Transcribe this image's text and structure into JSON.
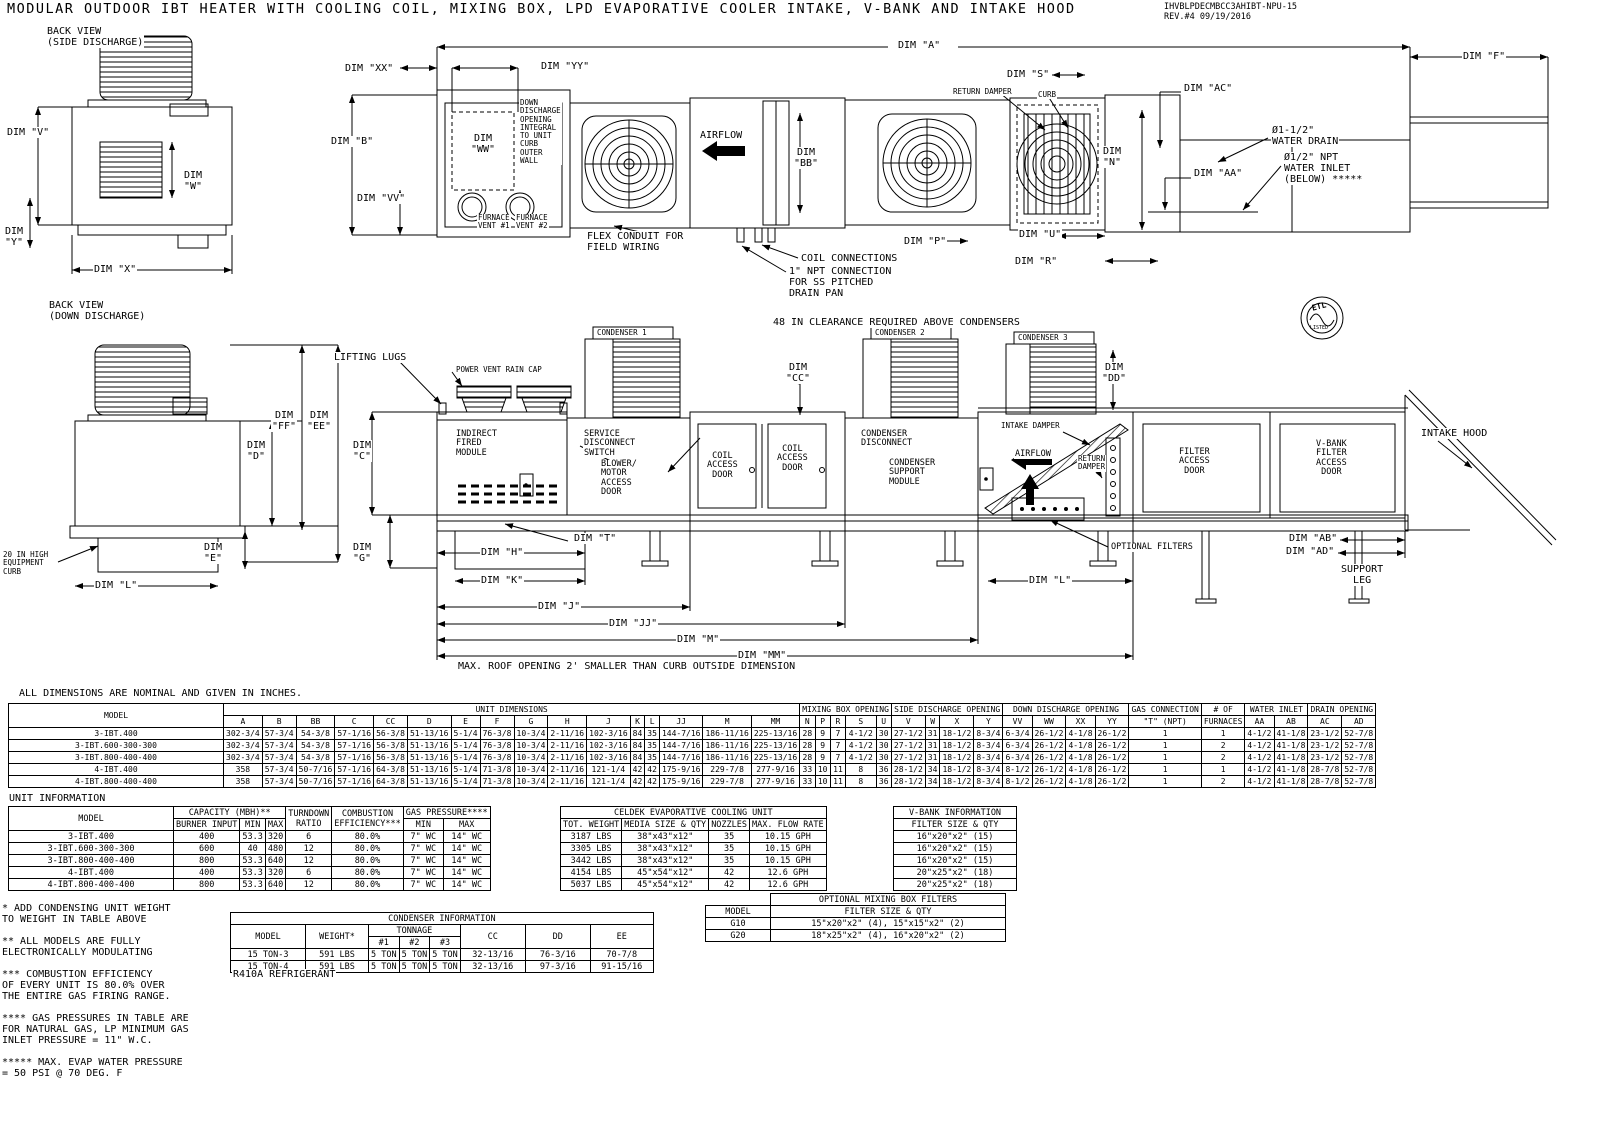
{
  "header": {
    "title": "MODULAR OUTDOOR IBT HEATER WITH COOLING COIL, MIXING BOX, LPD EVAPORATIVE COOLER INTAKE, V-BANK AND INTAKE HOOD",
    "doc_number": "IHVBLPDECMBCC3AHIBT-NPU-15",
    "revision": "REV.#4   09/19/2016"
  },
  "labels": {
    "back_view_side": "BACK VIEW\n(SIDE DISCHARGE)",
    "back_view_down": "BACK VIEW\n(DOWN DISCHARGE)",
    "dim_v": "DIM \"V\"",
    "dim_w": "DIM\n\"W\"",
    "dim_y": "DIM\n\"Y\"",
    "dim_x": "DIM \"X\"",
    "dim_xx": "DIM \"XX\"",
    "dim_yy": "DIM \"YY\"",
    "dim_a": "DIM \"A\"",
    "dim_f": "DIM \"F\"",
    "dim_b": "DIM \"B\"",
    "dim_ww": "DIM\n\"WW\"",
    "dim_vv": "DIM \"VV\"",
    "down_discharge_note": "DOWN\nDISCHARGE\nOPENING\nINTEGRAL\nTO UNIT\nCURB\nOUTER\nWALL",
    "furnace_vent_1": "FURNACE\nVENT #1",
    "furnace_vent_2": "FURNACE\nVENT #2",
    "flex_conduit": "FLEX CONDUIT FOR\nFIELD WIRING",
    "airflow": "AIRFLOW",
    "dim_bb": "DIM\n\"BB\"",
    "return_damper": "RETURN DAMPER",
    "curb": "CURB",
    "dim_s": "DIM \"S\"",
    "dim_ac": "DIM \"AC\"",
    "dim_n": "DIM\n\"N\"",
    "dim_aa": "DIM \"AA\"",
    "water_drain": "Ø1-1/2\"\nWATER DRAIN",
    "water_inlet": "Ø1/2\" NPT\nWATER INLET\n(BELOW) *****",
    "dim_p": "DIM \"P\"",
    "dim_u": "DIM \"U\"",
    "dim_r": "DIM \"R\"",
    "coil_connections": "COIL CONNECTIONS",
    "npt_connection": "1\" NPT CONNECTION\nFOR SS PITCHED\nDRAIN PAN",
    "clearance_note": "48 IN CLEARANCE REQUIRED ABOVE CONDENSERS",
    "condenser_1": "CONDENSER 1",
    "condenser_2": "CONDENSER 2",
    "condenser_3": "CONDENSER 3",
    "lifting_lugs": "LIFTING LUGS",
    "power_vent_rain_cap": "POWER VENT RAIN CAP",
    "dim_cc": "DIM\n\"CC\"",
    "dim_dd": "DIM\n\"DD\"",
    "dim_ff": "DIM\n\"FF\"",
    "dim_ee": "DIM\n\"EE\"",
    "dim_d": "DIM\n\"D\"",
    "dim_c": "DIM\n\"C\"",
    "indirect_fired_module": "INDIRECT\nFIRED\nMODULE",
    "service_disconnect_switch": "SERVICE\nDISCONNECT\nSWITCH",
    "blower_motor_access_door": "BLOWER/\nMOTOR\nACCESS\nDOOR",
    "coil_access_door": "COIL\nACCESS\nDOOR",
    "condenser_disconnect": "CONDENSER\nDISCONNECT",
    "condenser_support_module": "CONDENSER\nSUPPORT\nMODULE",
    "intake_damper": "INTAKE DAMPER",
    "return_damper_small": "RETURN\nDAMPER",
    "filter_access_door": "FILTER\nACCESS\nDOOR",
    "vbank_filter_access_door": "V-BANK\nFILTER\nACCESS\nDOOR",
    "intake_hood": "INTAKE HOOD",
    "optional_filters": "OPTIONAL FILTERS",
    "equipment_curb": "20 IN HIGH\nEQUIPMENT\nCURB",
    "dim_e": "DIM\n\"E\"",
    "dim_l": "DIM \"L\"",
    "dim_g": "DIM\n\"G\"",
    "dim_h": "DIM \"H\"",
    "dim_t": "DIM \"T\"",
    "dim_k": "DIM \"K\"",
    "dim_j": "DIM \"J\"",
    "dim_jj": "DIM \"JJ\"",
    "dim_m": "DIM \"M\"",
    "dim_mm": "DIM \"MM\"",
    "dim_ab": "DIM \"AB\"",
    "dim_ad": "DIM \"AD\"",
    "support_leg": "SUPPORT\nLEG",
    "roof_note": "MAX. ROOF OPENING 2' SMALLER THAN CURB OUTSIDE DIMENSION",
    "dims_note": "ALL DIMENSIONS ARE NOMINAL AND GIVEN IN INCHES.",
    "unit_information_heading": "UNIT INFORMATION",
    "refrigerant": "R410A REFRIGERANT",
    "etl": "ETL",
    "etl_listed": "LISTED"
  },
  "unit_dimensions": {
    "title": "UNIT DIMENSIONS",
    "model_header": "MODEL",
    "groups": {
      "mixing_box": "MIXING BOX OPENING",
      "side_discharge": "SIDE DISCHARGE OPENING",
      "down_discharge": "DOWN DISCHARGE OPENING",
      "gas_connection": "GAS CONNECTION",
      "furnaces_top": "# OF",
      "water_inlet": "WATER INLET",
      "drain_opening": "DRAIN OPENING"
    },
    "columns": [
      "A",
      "B",
      "BB",
      "C",
      "CC",
      "D",
      "E",
      "F",
      "G",
      "H",
      "J",
      "K",
      "L",
      "JJ",
      "M",
      "MM",
      "N",
      "P",
      "R",
      "S",
      "U",
      "V",
      "W",
      "X",
      "Y",
      "VV",
      "WW",
      "XX",
      "YY",
      "\"T\" (NPT)",
      "FURNACES",
      "AA",
      "AB",
      "AC",
      "AD"
    ],
    "rows": [
      [
        "3-IBT.400",
        "302-3/4",
        "57-3/4",
        "54-3/8",
        "57-1/16",
        "56-3/8",
        "51-13/16",
        "5-1/4",
        "76-3/8",
        "10-3/4",
        "2-11/16",
        "102-3/16",
        "84",
        "35",
        "144-7/16",
        "186-11/16",
        "225-13/16",
        "28",
        "9",
        "7",
        "4-1/2",
        "30",
        "27-1/2",
        "31",
        "18-1/2",
        "8-3/4",
        "6-3/4",
        "26-1/2",
        "4-1/8",
        "26-1/2",
        "1",
        "1",
        "4-1/2",
        "41-1/8",
        "23-1/2",
        "52-7/8"
      ],
      [
        "3-IBT.600-300-300",
        "302-3/4",
        "57-3/4",
        "54-3/8",
        "57-1/16",
        "56-3/8",
        "51-13/16",
        "5-1/4",
        "76-3/8",
        "10-3/4",
        "2-11/16",
        "102-3/16",
        "84",
        "35",
        "144-7/16",
        "186-11/16",
        "225-13/16",
        "28",
        "9",
        "7",
        "4-1/2",
        "30",
        "27-1/2",
        "31",
        "18-1/2",
        "8-3/4",
        "6-3/4",
        "26-1/2",
        "4-1/8",
        "26-1/2",
        "1",
        "2",
        "4-1/2",
        "41-1/8",
        "23-1/2",
        "52-7/8"
      ],
      [
        "3-IBT.800-400-400",
        "302-3/4",
        "57-3/4",
        "54-3/8",
        "57-1/16",
        "56-3/8",
        "51-13/16",
        "5-1/4",
        "76-3/8",
        "10-3/4",
        "2-11/16",
        "102-3/16",
        "84",
        "35",
        "144-7/16",
        "186-11/16",
        "225-13/16",
        "28",
        "9",
        "7",
        "4-1/2",
        "30",
        "27-1/2",
        "31",
        "18-1/2",
        "8-3/4",
        "6-3/4",
        "26-1/2",
        "4-1/8",
        "26-1/2",
        "1",
        "2",
        "4-1/2",
        "41-1/8",
        "23-1/2",
        "52-7/8"
      ],
      [
        "4-IBT.400",
        "358",
        "57-3/4",
        "50-7/16",
        "57-1/16",
        "64-3/8",
        "51-13/16",
        "5-1/4",
        "71-3/8",
        "10-3/4",
        "2-11/16",
        "121-1/4",
        "42",
        "42",
        "175-9/16",
        "229-7/8",
        "277-9/16",
        "33",
        "10",
        "11",
        "8",
        "36",
        "28-1/2",
        "34",
        "18-1/2",
        "8-3/4",
        "8-1/2",
        "26-1/2",
        "4-1/8",
        "26-1/2",
        "1",
        "1",
        "4-1/2",
        "41-1/8",
        "28-7/8",
        "52-7/8"
      ],
      [
        "4-IBT.800-400-400",
        "358",
        "57-3/4",
        "50-7/16",
        "57-1/16",
        "64-3/8",
        "51-13/16",
        "5-1/4",
        "71-3/8",
        "10-3/4",
        "2-11/16",
        "121-1/4",
        "42",
        "42",
        "175-9/16",
        "229-7/8",
        "277-9/16",
        "33",
        "10",
        "11",
        "8",
        "36",
        "28-1/2",
        "34",
        "18-1/2",
        "8-3/4",
        "8-1/2",
        "26-1/2",
        "4-1/8",
        "26-1/2",
        "1",
        "2",
        "4-1/2",
        "41-1/8",
        "28-7/8",
        "52-7/8"
      ]
    ]
  },
  "unit_information": {
    "model_header": "MODEL",
    "capacity_header": "CAPACITY (MBH)**",
    "turndown_header": "TURNDOWN\nRATIO",
    "combustion_header": "COMBUSTION\nEFFICIENCY***",
    "gas_pressure_header": "GAS PRESSURE****",
    "sub_columns": [
      "BURNER INPUT",
      "MIN",
      "MAX",
      "MIN",
      "MAX"
    ],
    "rows": [
      [
        "3-IBT.400",
        "400",
        "53.3",
        "320",
        "6",
        "80.0%",
        "7\" WC",
        "14\" WC"
      ],
      [
        "3-IBT.600-300-300",
        "600",
        "40",
        "480",
        "12",
        "80.0%",
        "7\" WC",
        "14\" WC"
      ],
      [
        "3-IBT.800-400-400",
        "800",
        "53.3",
        "640",
        "12",
        "80.0%",
        "7\" WC",
        "14\" WC"
      ],
      [
        "4-IBT.400",
        "400",
        "53.3",
        "320",
        "6",
        "80.0%",
        "7\" WC",
        "14\" WC"
      ],
      [
        "4-IBT.800-400-400",
        "800",
        "53.3",
        "640",
        "12",
        "80.0%",
        "7\" WC",
        "14\" WC"
      ]
    ]
  },
  "celdek": {
    "title": "CELDEK EVAPORATIVE COOLING UNIT",
    "columns": [
      "TOT. WEIGHT",
      "MEDIA SIZE & QTY",
      "NOZZLES",
      "MAX. FLOW RATE"
    ],
    "rows": [
      [
        "3187 LBS",
        "38\"x43\"x12\"",
        "35",
        "10.15 GPH"
      ],
      [
        "3305 LBS",
        "38\"x43\"x12\"",
        "35",
        "10.15 GPH"
      ],
      [
        "3442 LBS",
        "38\"x43\"x12\"",
        "35",
        "10.15 GPH"
      ],
      [
        "4154 LBS",
        "45\"x54\"x12\"",
        "42",
        "12.6 GPH"
      ],
      [
        "5037 LBS",
        "45\"x54\"x12\"",
        "42",
        "12.6 GPH"
      ]
    ]
  },
  "vbank": {
    "title": "V-BANK INFORMATION",
    "column": "FILTER SIZE & QTY",
    "rows": [
      [
        "16\"x20\"x2\" (15)"
      ],
      [
        "16\"x20\"x2\" (15)"
      ],
      [
        "16\"x20\"x2\" (15)"
      ],
      [
        "20\"x25\"x2\" (18)"
      ],
      [
        "20\"x25\"x2\" (18)"
      ]
    ]
  },
  "condenser": {
    "title": "CONDENSER INFORMATION",
    "model_header": "MODEL",
    "weight_header": "WEIGHT*",
    "tonnage_header": "TONNAGE",
    "tonnage_cols": [
      "#1",
      "#2",
      "#3"
    ],
    "cc_header": "CC",
    "dd_header": "DD",
    "ee_header": "EE",
    "rows": [
      [
        "15 TON-3",
        "591 LBS",
        "5 TON",
        "5 TON",
        "5 TON",
        "32-13/16",
        "76-3/16",
        "70-7/8"
      ],
      [
        "15 TON-4",
        "591 LBS",
        "5 TON",
        "5 TON",
        "5 TON",
        "32-13/16",
        "97-3/16",
        "91-15/16"
      ]
    ]
  },
  "mixing_box_filters": {
    "title": "OPTIONAL MIXING BOX FILTERS",
    "model_header": "MODEL",
    "filter_header": "FILTER SIZE & QTY",
    "rows": [
      [
        "G10",
        "15\"x20\"x2\" (4), 15\"x15\"x2\" (2)"
      ],
      [
        "G20",
        "18\"x25\"x2\" (4), 16\"x20\"x2\" (2)"
      ]
    ]
  },
  "footnotes": [
    "* ADD CONDENSING UNIT WEIGHT\nTO WEIGHT IN TABLE ABOVE",
    "** ALL MODELS ARE FULLY\n ELECTRONICALLY MODULATING",
    "*** COMBUSTION EFFICIENCY\nOF EVERY UNIT IS 80.0% OVER\nTHE ENTIRE GAS FIRING RANGE.",
    "**** GAS PRESSURES IN TABLE ARE\nFOR NATURAL GAS,  LP MINIMUM GAS\nINLET PRESSURE = 11\" W.C.",
    "***** MAX. EVAP WATER PRESSURE\n= 50 PSI @ 70 DEG. F"
  ]
}
